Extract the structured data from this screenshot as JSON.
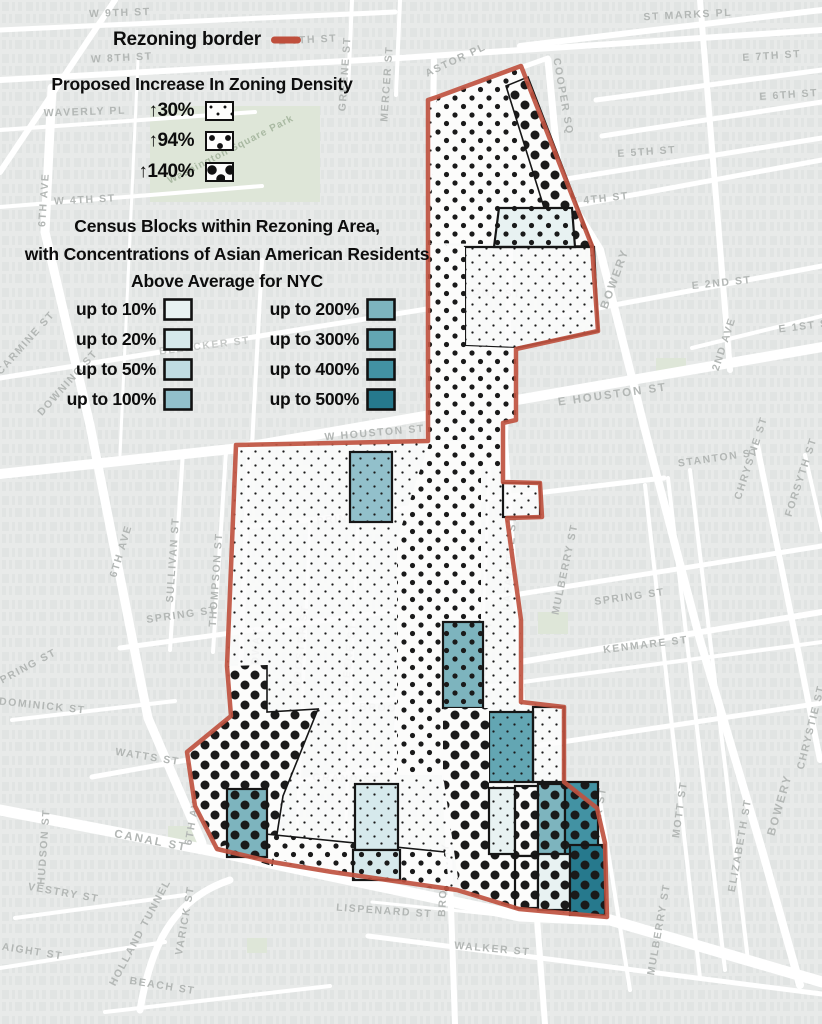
{
  "legend": {
    "border": {
      "label": "Rezoning border",
      "color": "#bf4f3c"
    },
    "density": {
      "title": "Proposed Increase In Zoning Density",
      "arrow": "↑",
      "items": [
        {
          "pct": "30%",
          "pattern": "small-dots"
        },
        {
          "pct": "94%",
          "pattern": "medium-dots"
        },
        {
          "pct": "140%",
          "pattern": "large-dots"
        }
      ]
    },
    "census": {
      "title_line1": "Census Blocks within Rezoning Area,",
      "title_line2": "with Concentrations of Asian American Residents",
      "title_line3": "Above Average for NYC",
      "left": [
        {
          "label": "up to 10%",
          "color": "#e8f2f2"
        },
        {
          "label": "up to 20%",
          "color": "#d6e9ec"
        },
        {
          "label": "up to 50%",
          "color": "#c0dce2"
        },
        {
          "label": "up to 100%",
          "color": "#92c0cb"
        }
      ],
      "right": [
        {
          "label": "up to 200%",
          "color": "#7db4be"
        },
        {
          "label": "up to 300%",
          "color": "#63a6b3"
        },
        {
          "label": "up to 400%",
          "color": "#4292a3"
        },
        {
          "label": "up to 500%",
          "color": "#26798d"
        }
      ]
    }
  },
  "map": {
    "park_label": "Washington Square Park",
    "dot_color": "#1a1a1a",
    "border_color": "#bf5340",
    "streets": [
      {
        "label": "W 9TH ST"
      },
      {
        "label": "ST MARKS PL"
      },
      {
        "label": "W 8TH ST"
      },
      {
        "label": "E 8TH ST"
      },
      {
        "label": "E 7TH ST"
      },
      {
        "label": "E 6TH ST"
      },
      {
        "label": "E 5TH ST"
      },
      {
        "label": "E 4TH ST"
      },
      {
        "label": "W 4TH ST"
      },
      {
        "label": "WAVERLY PL"
      },
      {
        "label": "ASTOR PL"
      },
      {
        "label": "COOPER SQ"
      },
      {
        "label": "E 2ND ST"
      },
      {
        "label": "BOND ST"
      },
      {
        "label": "BOWERY"
      },
      {
        "label": "2ND AVE"
      },
      {
        "label": "E HOUSTON ST"
      },
      {
        "label": "W HOUSTON ST"
      },
      {
        "label": "STANTON ST"
      },
      {
        "label": "CHRYSTIE ST"
      },
      {
        "label": "FORSYTH ST"
      },
      {
        "label": "PRINCE ST"
      },
      {
        "label": "SPRING ST"
      },
      {
        "label": "KENMARE ST"
      },
      {
        "label": "SPRING ST"
      },
      {
        "label": "SULLIVAN ST"
      },
      {
        "label": "THOMPSON ST"
      },
      {
        "label": "6TH AVE"
      },
      {
        "label": "6TH AVE"
      },
      {
        "label": "CARMINE ST"
      },
      {
        "label": "DOWNING ST"
      },
      {
        "label": "W BROADWAY"
      },
      {
        "label": "WOOSTER ST"
      },
      {
        "label": "GREENE ST"
      },
      {
        "label": "BROADWAY"
      },
      {
        "label": "CROSBY ST"
      },
      {
        "label": "LAFAYETTE ST"
      },
      {
        "label": "MULBERRY ST"
      },
      {
        "label": "BROOME ST"
      },
      {
        "label": "GRAND ST"
      },
      {
        "label": "CANAL ST"
      },
      {
        "label": "CANAL ST"
      },
      {
        "label": "LISPENARD ST"
      },
      {
        "label": "WALKER ST"
      },
      {
        "label": "BAXTER ST"
      },
      {
        "label": "MULBERRY ST"
      },
      {
        "label": "MOTT ST"
      },
      {
        "label": "ELIZABETH ST"
      },
      {
        "label": "BOWERY"
      },
      {
        "label": "CHRYSTIE ST"
      },
      {
        "label": "HUDSON ST"
      },
      {
        "label": "VARICK ST"
      },
      {
        "label": "HOLLAND TUNNEL"
      },
      {
        "label": "6TH AVE"
      },
      {
        "label": "WATTS ST"
      },
      {
        "label": "DOMINICK ST"
      },
      {
        "label": "VESTRY ST"
      },
      {
        "label": "BEACH ST"
      },
      {
        "label": "LAIGHT ST"
      },
      {
        "label": "MERCER ST"
      },
      {
        "label": "GREENE ST"
      },
      {
        "label": "BLEECKER ST"
      },
      {
        "label": "E 1ST ST"
      },
      {
        "label": "SPRING ST"
      }
    ]
  }
}
